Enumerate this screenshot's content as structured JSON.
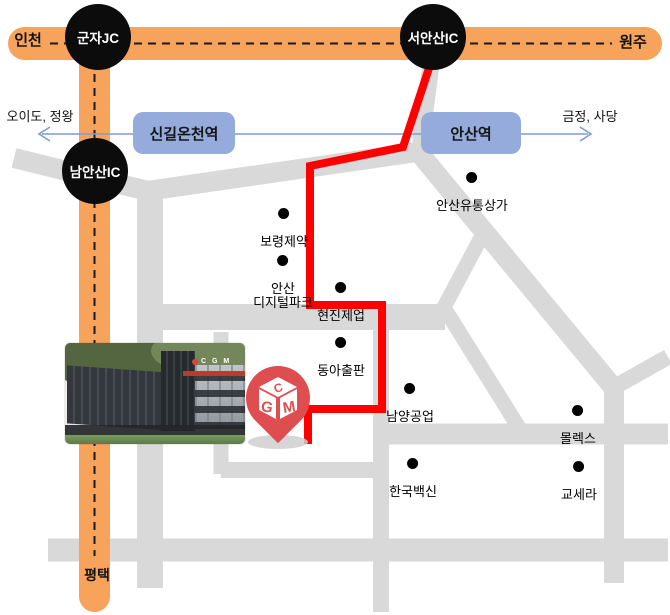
{
  "map": {
    "highway": {
      "left_label": "인천",
      "right_label": "원주",
      "bottom_label": "평택"
    },
    "junctions": [
      {
        "label": "군자JC"
      },
      {
        "label": "서안산IC"
      },
      {
        "label": "남안산IC"
      }
    ],
    "stations": [
      {
        "label": "신길온천역"
      },
      {
        "label": "안산역"
      }
    ],
    "rail_directions": {
      "left": "오이도, 정왕",
      "right": "금정, 사당"
    },
    "landmarks": [
      {
        "label": "보령제약"
      },
      {
        "label": "안산\n디지털파크"
      },
      {
        "label": "현진제업"
      },
      {
        "label": "동아출판"
      },
      {
        "label": "남양공업"
      },
      {
        "label": "안산유통상가"
      },
      {
        "label": "몰렉스"
      },
      {
        "label": "한국백신"
      },
      {
        "label": "교세라"
      }
    ],
    "pin": {
      "top_letter": "C",
      "left_letter": "G",
      "right_letter": "M"
    },
    "building_photo": {
      "logo_text": "C G M"
    },
    "colors": {
      "highway-orange": "#F8A35C",
      "road-gray": "#D9D9D9",
      "route-red": "#FF0000",
      "station-blue": "#94ABDC",
      "rail-blue": "#7E9BD0",
      "junction-black": "#0C0C0C",
      "pin-red": "#DE4E50",
      "dash-black": "#1A1A1A"
    }
  }
}
